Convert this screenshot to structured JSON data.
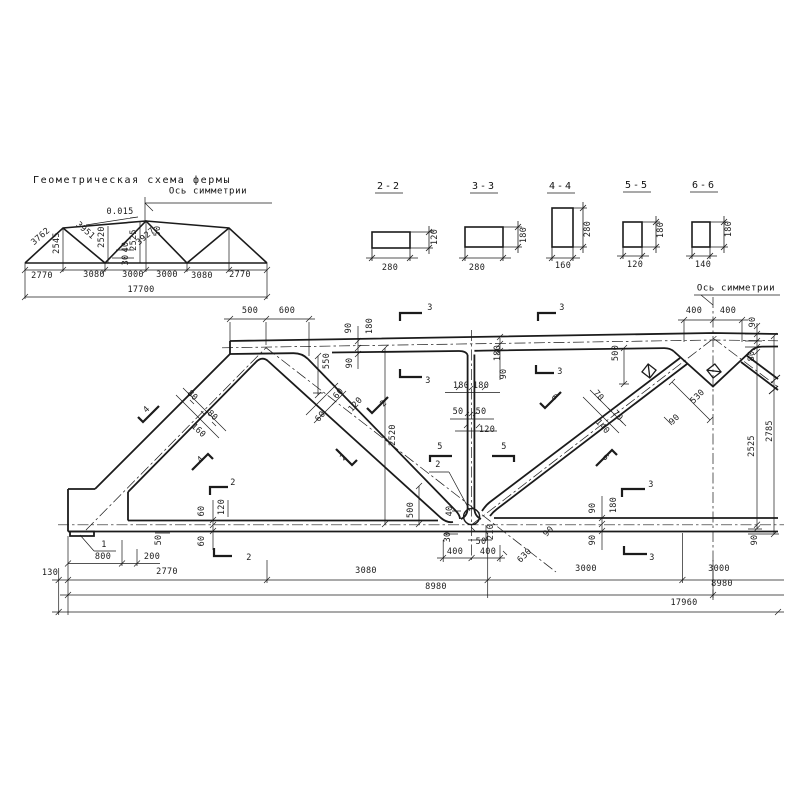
{
  "page": {
    "background": "#ffffff",
    "ink": "#1b1b1b"
  },
  "schema": {
    "title": "Геометрическая схема фермы",
    "axis_label": "Ось симметрии",
    "slope_label": "0.015",
    "panel_dims": [
      "2770",
      "3080",
      "3000",
      "3000",
      "3080",
      "2770"
    ],
    "total_dim": "17700",
    "member_lengths": {
      "end_diagonal": "3762",
      "post_1": "2545",
      "diagonal_2": "3951",
      "post_2": "2520",
      "diagonal_3": "3927",
      "post_3": "2525",
      "offset_a": "40",
      "offset_b": "30",
      "offset_c": "50"
    }
  },
  "sections": {
    "items": [
      {
        "label": "2-2",
        "width": "280",
        "height": "120"
      },
      {
        "label": "3-3",
        "width": "280",
        "height": "180"
      },
      {
        "label": "4-4",
        "width": "160",
        "height": "280"
      },
      {
        "label": "5-5",
        "width": "120",
        "height": "180"
      },
      {
        "label": "6-6",
        "width": "140",
        "height": "180"
      }
    ]
  },
  "main": {
    "axis_label": "Ось симметрии",
    "detail_marks": [
      "1",
      "2"
    ],
    "section_cut_marks": [
      "2",
      "3",
      "4",
      "5",
      "6"
    ],
    "bottom_dims": [
      "130",
      "2770",
      "3080",
      "3000",
      "3000",
      "8980",
      "8980",
      "17960"
    ],
    "top_dims": [
      "500",
      "600",
      "400",
      "400"
    ],
    "height_dims": [
      "2525",
      "2785",
      "2520"
    ]
  },
  "labels": [
    {
      "n": "schema-slope",
      "t": "0.015",
      "x": 120,
      "y": 212
    },
    {
      "n": "schema-diag-1",
      "t": "3762",
      "x": 41,
      "y": 237,
      "r": -41
    },
    {
      "n": "schema-post-1",
      "t": "2545",
      "x": 57,
      "y": 243,
      "r": -90
    },
    {
      "n": "schema-diag-2",
      "t": "3951",
      "x": 85,
      "y": 231,
      "r": 41
    },
    {
      "n": "schema-post-2",
      "t": "2520",
      "x": 102,
      "y": 237,
      "r": -90
    },
    {
      "n": "schema-offset-40",
      "t": "40",
      "x": 126,
      "y": 247,
      "r": -90
    },
    {
      "n": "schema-offset-30",
      "t": "30",
      "x": 126,
      "y": 260,
      "r": -90
    },
    {
      "n": "schema-diag-3",
      "t": "3927",
      "x": 146,
      "y": 237,
      "r": -41
    },
    {
      "n": "schema-post-3",
      "t": "2525",
      "x": 134,
      "y": 240,
      "r": -90
    },
    {
      "n": "schema-offset-50",
      "t": "50",
      "x": 158,
      "y": 231,
      "r": -90
    },
    {
      "n": "schema-panel-1",
      "t": "2770",
      "x": 42,
      "y": 276
    },
    {
      "n": "schema-panel-2",
      "t": "3080",
      "x": 94,
      "y": 275
    },
    {
      "n": "schema-panel-3",
      "t": "3000",
      "x": 133,
      "y": 275
    },
    {
      "n": "schema-panel-4",
      "t": "3000",
      "x": 167,
      "y": 275
    },
    {
      "n": "schema-panel-5",
      "t": "3080",
      "x": 202,
      "y": 276
    },
    {
      "n": "schema-panel-6",
      "t": "2770",
      "x": 240,
      "y": 275
    },
    {
      "n": "schema-total",
      "t": "17700",
      "x": 141,
      "y": 290
    },
    {
      "n": "sec22-w",
      "t": "280",
      "x": 390,
      "y": 268
    },
    {
      "n": "sec22-h",
      "t": "120",
      "x": 435,
      "y": 237,
      "r": -90
    },
    {
      "n": "sec33-w",
      "t": "280",
      "x": 477,
      "y": 268
    },
    {
      "n": "sec33-h",
      "t": "180",
      "x": 524,
      "y": 235,
      "r": -90
    },
    {
      "n": "sec44-w",
      "t": "160",
      "x": 563,
      "y": 266
    },
    {
      "n": "sec44-h",
      "t": "280",
      "x": 588,
      "y": 229,
      "r": -90
    },
    {
      "n": "sec55-w",
      "t": "120",
      "x": 635,
      "y": 265
    },
    {
      "n": "sec55-h",
      "t": "180",
      "x": 661,
      "y": 230,
      "r": -90
    },
    {
      "n": "sec66-w",
      "t": "140",
      "x": 703,
      "y": 265
    },
    {
      "n": "sec66-h",
      "t": "180",
      "x": 729,
      "y": 229,
      "r": -90
    },
    {
      "n": "dim-500-top",
      "t": "500",
      "x": 250,
      "y": 311
    },
    {
      "n": "dim-600-top",
      "t": "600",
      "x": 287,
      "y": 311
    },
    {
      "n": "dim-400-l",
      "t": "400",
      "x": 694,
      "y": 311
    },
    {
      "n": "dim-400-r",
      "t": "400",
      "x": 728,
      "y": 311
    },
    {
      "n": "dim-90-tr",
      "t": "90",
      "x": 753,
      "y": 322,
      "r": -90
    },
    {
      "n": "dim-80-tr",
      "t": "80",
      "x": 752,
      "y": 356,
      "r": -90
    },
    {
      "n": "dim-90-j1a",
      "t": "90",
      "x": 349,
      "y": 328,
      "r": -90
    },
    {
      "n": "dim-180-j1",
      "t": "180",
      "x": 370,
      "y": 326,
      "r": -90
    },
    {
      "n": "dim-90-j1b",
      "t": "90",
      "x": 350,
      "y": 363,
      "r": -90
    },
    {
      "n": "dim-550",
      "t": "550",
      "x": 327,
      "y": 361,
      "r": -90
    },
    {
      "n": "dim-180-mid",
      "t": "180",
      "x": 498,
      "y": 353,
      "r": -90
    },
    {
      "n": "dim-90-mid",
      "t": "90",
      "x": 504,
      "y": 374,
      "r": -90
    },
    {
      "n": "dim-500-right",
      "t": "500",
      "x": 616,
      "y": 353,
      "r": -90
    },
    {
      "n": "dim-530",
      "t": "530",
      "x": 698,
      "y": 397,
      "r": -45
    },
    {
      "n": "dim-90-gusset",
      "t": "90",
      "x": 675,
      "y": 420,
      "r": -45
    },
    {
      "n": "dim-2525",
      "t": "2525",
      "x": 752,
      "y": 446,
      "r": -90
    },
    {
      "n": "dim-2785",
      "t": "2785",
      "x": 770,
      "y": 431,
      "r": -90
    },
    {
      "n": "dim-90-br",
      "t": "90",
      "x": 755,
      "y": 540,
      "r": -90
    },
    {
      "n": "dim-2520",
      "t": "2520",
      "x": 393,
      "y": 435,
      "r": -90
    },
    {
      "n": "dim-180-v1",
      "t": "180",
      "x": 461,
      "y": 386
    },
    {
      "n": "dim-180-v2",
      "t": "180",
      "x": 481,
      "y": 386
    },
    {
      "n": "dim-50-v1",
      "t": "50",
      "x": 458,
      "y": 412
    },
    {
      "n": "dim-50-v2",
      "t": "50",
      "x": 481,
      "y": 412
    },
    {
      "n": "dim-120-v",
      "t": "120",
      "x": 487,
      "y": 430
    },
    {
      "n": "dim-60-d2a",
      "t": "60",
      "x": 339,
      "y": 394,
      "r": -48
    },
    {
      "n": "dim-60-d2b",
      "t": "60",
      "x": 321,
      "y": 417,
      "r": -48
    },
    {
      "n": "dim-120-d2",
      "t": "120",
      "x": 356,
      "y": 405,
      "r": -48
    },
    {
      "n": "dim-80-d1a",
      "t": "80",
      "x": 192,
      "y": 396,
      "r": 43
    },
    {
      "n": "dim-80-d1b",
      "t": "80",
      "x": 212,
      "y": 416,
      "r": 43
    },
    {
      "n": "dim-160-d1",
      "t": "160",
      "x": 198,
      "y": 431,
      "r": 43
    },
    {
      "n": "dim-70-d3a",
      "t": "70",
      "x": 598,
      "y": 396,
      "r": 48
    },
    {
      "n": "dim-70-d3b",
      "t": "70",
      "x": 617,
      "y": 416,
      "r": 48
    },
    {
      "n": "dim-140-d3",
      "t": "140",
      "x": 602,
      "y": 427,
      "r": 48
    },
    {
      "n": "dim-60-bl1",
      "t": "60",
      "x": 202,
      "y": 511,
      "r": -90
    },
    {
      "n": "dim-120-bl",
      "t": "120",
      "x": 222,
      "y": 507,
      "r": -90
    },
    {
      "n": "dim-60-bl2",
      "t": "60",
      "x": 202,
      "y": 541,
      "r": -90
    },
    {
      "n": "dim-50-bl",
      "t": "50",
      "x": 159,
      "y": 540,
      "r": -90
    },
    {
      "n": "dim-500-bc",
      "t": "500",
      "x": 411,
      "y": 510,
      "r": -90
    },
    {
      "n": "dim-40-bc",
      "t": "40",
      "x": 450,
      "y": 511,
      "r": -90
    },
    {
      "n": "dim-30-bc",
      "t": "30",
      "x": 448,
      "y": 537,
      "r": -90
    },
    {
      "n": "dim-50-bc",
      "t": "50",
      "x": 481,
      "y": 542
    },
    {
      "n": "dim-210-bc",
      "t": "210",
      "x": 491,
      "y": 532,
      "r": -90
    },
    {
      "n": "dim-90-bc",
      "t": "90",
      "x": 549,
      "y": 532,
      "r": -45
    },
    {
      "n": "dim-630",
      "t": "630",
      "x": 525,
      "y": 556,
      "r": -45
    },
    {
      "n": "dim-90-brc1",
      "t": "90",
      "x": 593,
      "y": 508,
      "r": -90
    },
    {
      "n": "dim-180-brc",
      "t": "180",
      "x": 614,
      "y": 505,
      "r": -90
    },
    {
      "n": "dim-90-brc2",
      "t": "90",
      "x": 593,
      "y": 540,
      "r": -90
    },
    {
      "n": "dim-800",
      "t": "800",
      "x": 103,
      "y": 557
    },
    {
      "n": "dim-200",
      "t": "200",
      "x": 152,
      "y": 557
    },
    {
      "n": "dim-400-b1",
      "t": "400",
      "x": 455,
      "y": 552
    },
    {
      "n": "dim-400-b2",
      "t": "400",
      "x": 488,
      "y": 552
    },
    {
      "n": "dim-130",
      "t": "130",
      "x": 50,
      "y": 573
    },
    {
      "n": "dim-2770-b",
      "t": "2770",
      "x": 167,
      "y": 572
    },
    {
      "n": "dim-3080-b",
      "t": "3080",
      "x": 366,
      "y": 571
    },
    {
      "n": "dim-3000-b1",
      "t": "3000",
      "x": 586,
      "y": 569
    },
    {
      "n": "dim-3000-b2",
      "t": "3000",
      "x": 719,
      "y": 569
    },
    {
      "n": "dim-8980-l",
      "t": "8980",
      "x": 436,
      "y": 587
    },
    {
      "n": "dim-8980-r",
      "t": "8980",
      "x": 722,
      "y": 584
    },
    {
      "n": "dim-17960",
      "t": "17960",
      "x": 684,
      "y": 603
    },
    {
      "n": "cut-3-t1",
      "t": "3",
      "x": 430,
      "y": 308
    },
    {
      "n": "cut-3-b1",
      "t": "3",
      "x": 428,
      "y": 381
    },
    {
      "n": "cut-3-t2",
      "t": "3",
      "x": 562,
      "y": 308
    },
    {
      "n": "cut-3-b2",
      "t": "3",
      "x": 560,
      "y": 372
    },
    {
      "n": "cut-3-t3",
      "t": "3",
      "x": 651,
      "y": 485
    },
    {
      "n": "cut-3-b3",
      "t": "3",
      "x": 652,
      "y": 558
    },
    {
      "n": "cut-2-t",
      "t": "2",
      "x": 233,
      "y": 483
    },
    {
      "n": "cut-2-b",
      "t": "2",
      "x": 249,
      "y": 558
    },
    {
      "n": "cut-4-a",
      "t": "4",
      "x": 147,
      "y": 410,
      "r": -45
    },
    {
      "n": "cut-4-b",
      "t": "4",
      "x": 201,
      "y": 460,
      "r": -45
    },
    {
      "n": "cut-2-d2a",
      "t": "2",
      "x": 384,
      "y": 404,
      "r": -45
    },
    {
      "n": "cut-2-d2b",
      "t": "2",
      "x": 344,
      "y": 458,
      "r": -45
    },
    {
      "n": "cut-5-a",
      "t": "5",
      "x": 440,
      "y": 447
    },
    {
      "n": "cut-5-b",
      "t": "5",
      "x": 504,
      "y": 447
    },
    {
      "n": "cut-6-a",
      "t": "6",
      "x": 554,
      "y": 398,
      "r": 45
    },
    {
      "n": "cut-6-b",
      "t": "6",
      "x": 605,
      "y": 458,
      "r": 45
    },
    {
      "n": "detail-1",
      "t": "1",
      "x": 104,
      "y": 545
    },
    {
      "n": "detail-2",
      "t": "2",
      "x": 438,
      "y": 465
    }
  ]
}
